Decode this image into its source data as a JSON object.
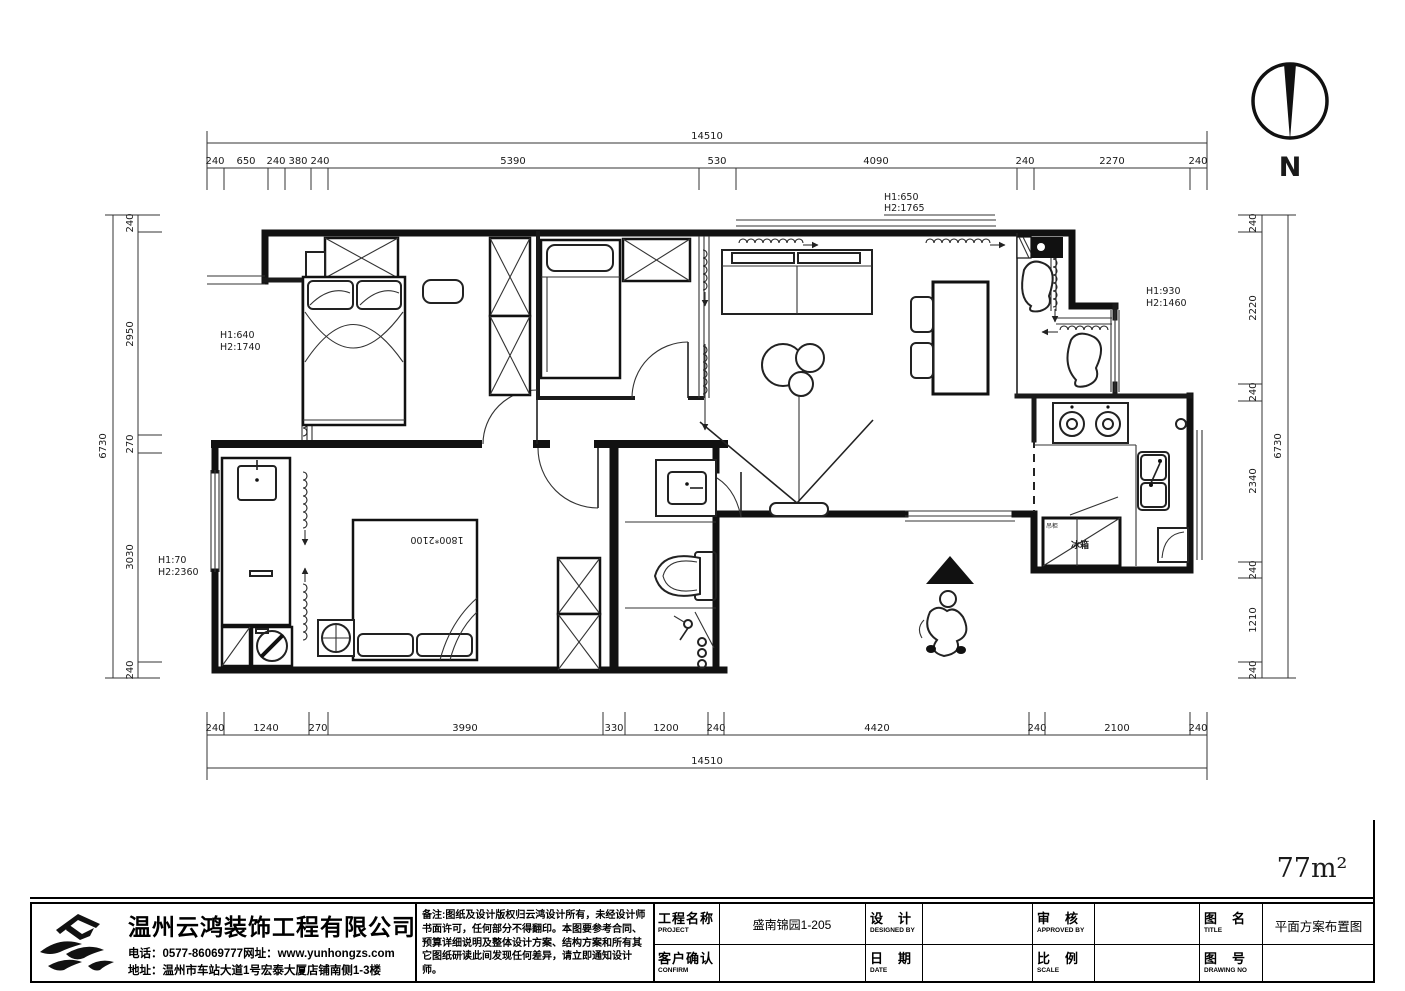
{
  "plan": {
    "area_label": "77m²",
    "north_label": "N",
    "bed_size_label": "1800*2100",
    "fridge_label": "冰箱",
    "fridge_cabinet_label": "吊柜",
    "window_labels": {
      "top": {
        "l1": "H1:650",
        "l2": "H2:1765"
      },
      "right": {
        "l1": "H1:930",
        "l2": "H2:1460"
      },
      "left_upper": {
        "l1": "H1:640",
        "l2": "H2:1740"
      },
      "left_lower": {
        "l1": "H1:70",
        "l2": "H2:2360"
      }
    }
  },
  "dims": {
    "top_total": "14510",
    "bottom_total": "14510",
    "left_total": "6730",
    "right_total": "6730",
    "top": [
      "240",
      "650",
      "240",
      "380",
      "240",
      "5390",
      "530",
      "4090",
      "240",
      "2270",
      "240"
    ],
    "bottom": [
      "240",
      "1240",
      "270",
      "3990",
      "330",
      "1200",
      "240",
      "4420",
      "240",
      "2100",
      "240"
    ],
    "left": [
      "240",
      "2950",
      "270",
      "3030",
      "240"
    ],
    "right": [
      "240",
      "2220",
      "240",
      "2340",
      "240",
      "1210",
      "240"
    ]
  },
  "title_block": {
    "company": {
      "name": "温州云鸿装饰工程有限公司",
      "line2": "电话：0577-86069777网址：www.yunhongzs.com",
      "line3": "地址：温州市车站大道1号宏泰大厦店铺南侧1-3楼"
    },
    "notes": {
      "l1": "备注:图纸及设计版权归云鸿设计所有，未经设计师",
      "l2": "书面许可，任何部分不得翻印。本图要参考合同、",
      "l3": "预算详细说明及整体设计方案、结构方案和所有其",
      "l4": "它图纸研读此间发现任何差异，请立即通知设计师。"
    },
    "fields": {
      "project_label": "工程名称",
      "project_label_en": "PROJECT",
      "project_value": "盛南锦园1-205",
      "designed_label": "设　计",
      "designed_label_en": "DESIGNED BY",
      "designed_value": "",
      "approved_label": "审　核",
      "approved_label_en": "APPROVED BY",
      "approved_value": "",
      "title_label": "图　名",
      "title_label_en": "TITLE",
      "title_value": "平面方案布置图",
      "confirm_label": "客户确认",
      "confirm_label_en": "CONFIRM",
      "confirm_value": "",
      "date_label": "日　期",
      "date_label_en": "DATE",
      "date_value": "",
      "scale_label": "比　例",
      "scale_label_en": "SCALE",
      "scale_value": "",
      "drawing_no_label": "图　号",
      "drawing_no_label_en": "DRAWING NO",
      "drawing_no_value": ""
    }
  }
}
